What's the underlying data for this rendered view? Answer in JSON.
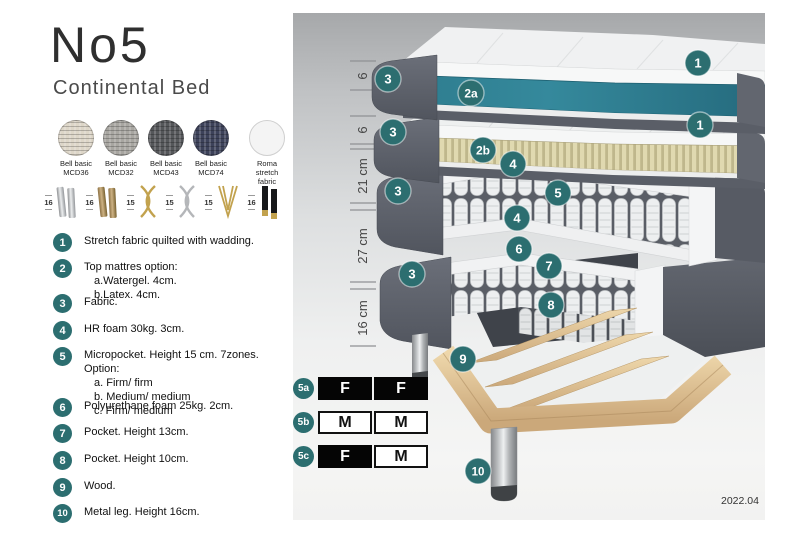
{
  "title": "No5",
  "subtitle": "Continental Bed",
  "fabrics": [
    {
      "line1": "Bell basic",
      "line2": "MCD36"
    },
    {
      "line1": "Bell basic",
      "line2": "MCD32"
    },
    {
      "line1": "Bell basic",
      "line2": "MCD43"
    },
    {
      "line1": "Bell basic",
      "line2": "MCD74"
    },
    {
      "line1": "Roma",
      "line2": "stretch fabric"
    }
  ],
  "legs": [
    {
      "size": "16",
      "type": "chrome-cylinder-legs"
    },
    {
      "size": "16",
      "type": "brass-cylinder-legs"
    },
    {
      "size": "15",
      "type": "gold-cross-legs"
    },
    {
      "size": "15",
      "type": "silver-cross-legs"
    },
    {
      "size": "15",
      "type": "gold-hairpin-legs"
    },
    {
      "size": "16",
      "type": "black-gold-legs"
    }
  ],
  "list": [
    {
      "num": "1",
      "text": "Stretch fabric quilted with wadding."
    },
    {
      "num": "2",
      "text": "Top mattres option:",
      "subs": [
        "a.Watergel. 4cm.",
        "b.Latex. 4cm."
      ]
    },
    {
      "num": "3",
      "text": "Fabric."
    },
    {
      "num": "4",
      "text": "HR foam 30kg. 3cm."
    },
    {
      "num": "5",
      "text": "Micropocket. Height 15 cm. 7zones. Option:",
      "subs": [
        "a. Firm/ firm",
        "b. Medium/ medium",
        "c. Firm/ medium"
      ]
    },
    {
      "num": "6",
      "text": "Polyurethane foam 25kg. 2cm."
    },
    {
      "num": "7",
      "text": "Pocket. Height 13cm."
    },
    {
      "num": "8",
      "text": "Pocket. Height 10cm."
    },
    {
      "num": "9",
      "text": "Wood."
    },
    {
      "num": "10",
      "text": "Metal leg. Height 16cm."
    }
  ],
  "diagram": {
    "scale": [
      "6",
      "6",
      "21 cm",
      "27 cm",
      "16 cm"
    ],
    "badges": {
      "n1": "1",
      "n2a": "2a",
      "n2b": "2b",
      "n3": "3",
      "n4": "4",
      "n5": "5",
      "n6": "6",
      "n7": "7",
      "n8": "8",
      "n9": "9",
      "n10": "10"
    },
    "firmness": [
      {
        "label": "5a",
        "cell1": "F",
        "cell2": "F"
      },
      {
        "label": "5b",
        "cell1": "M",
        "cell2": "M"
      },
      {
        "label": "5c",
        "cell1": "F",
        "cell2": "M"
      }
    ],
    "version": "2022.04"
  },
  "colors": {
    "accent_teal": "#2c6e70",
    "watergel_teal": "#2f7f92",
    "latex_tan": "#ddd5a8",
    "fabric_gray": "#5d616b",
    "wood": "#e2c89c"
  }
}
